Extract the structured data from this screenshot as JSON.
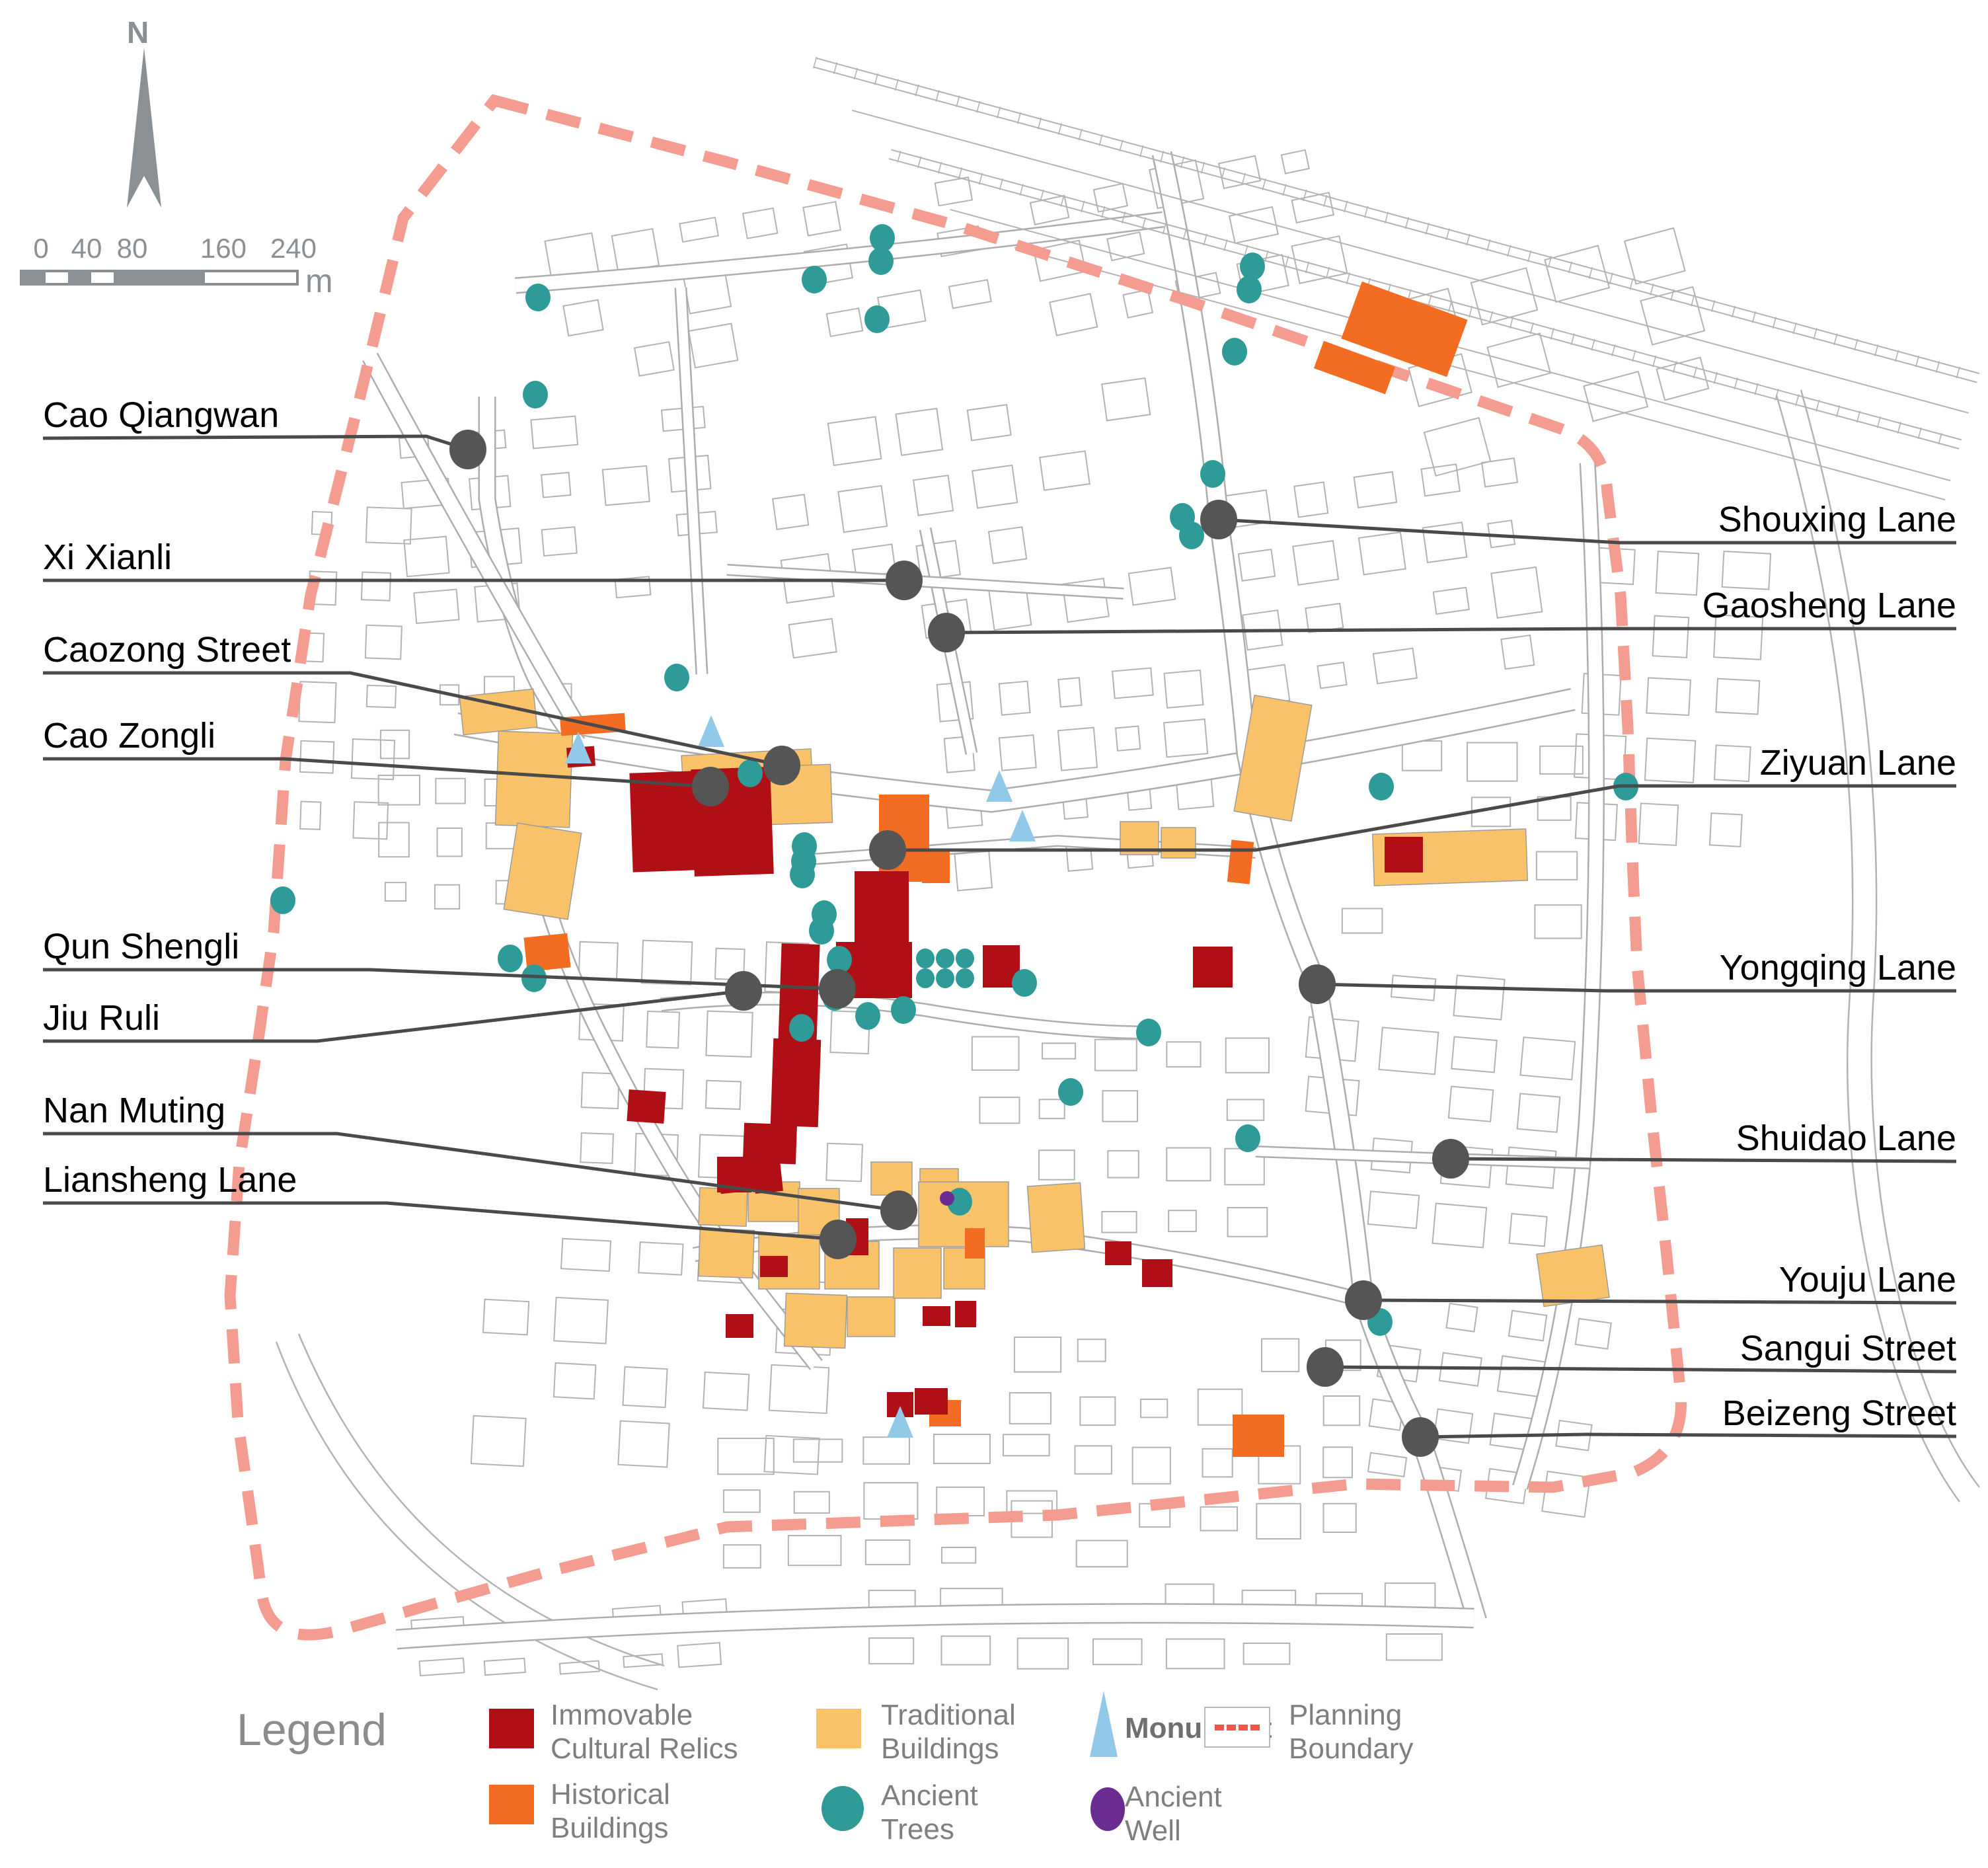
{
  "compass": {
    "north_label": "N"
  },
  "scale_bar": {
    "tick_labels": [
      "0",
      "40",
      "80",
      "160",
      "240"
    ],
    "unit_label": "m"
  },
  "streets_left": [
    "Cao Qiangwan",
    "Xi Xianli",
    "Caozong Street",
    "Cao Zongli",
    "Qun Shengli",
    "Jiu Ruli",
    "Nan Muting",
    "Liansheng Lane"
  ],
  "streets_right": [
    "Shouxing Lane",
    "Gaosheng Lane",
    "Ziyuan Lane",
    "Yongqing Lane",
    "Shuidao Lane",
    "Youju Lane",
    "Sangui Street",
    "Beizeng Street"
  ],
  "legend": {
    "title": "Legend",
    "items": [
      {
        "id": "immovable",
        "label": "Immovable Cultural Relics",
        "marker": "square",
        "color": "#B01015"
      },
      {
        "id": "historical",
        "label": "Historical Buildings",
        "marker": "square",
        "color": "#F26C21"
      },
      {
        "id": "traditional",
        "label": "Traditional Buildings",
        "marker": "square",
        "color": "#FBC369"
      },
      {
        "id": "ancient-trees",
        "label": "Ancient Trees",
        "marker": "circle",
        "color": "#2E9B98"
      },
      {
        "id": "monument",
        "label": "Monument",
        "marker": "triangle",
        "color": "#92C9E9"
      },
      {
        "id": "ancient-well",
        "label": "Ancient Well",
        "marker": "circle",
        "color": "#6A2C91"
      },
      {
        "id": "planning-boundary",
        "label": "Planning Boundary",
        "marker": "dashed-line",
        "color": "#F4544B"
      }
    ]
  },
  "colors": {
    "immovable": "#B01015",
    "historical": "#F26C21",
    "traditional": "#FBC369",
    "tree": "#2E9B98",
    "monument": "#92C9E9",
    "well": "#6A2C91",
    "boundary": "#F59C90",
    "map_line": "#B3B3B3",
    "road_edge": "#ADADAD",
    "leader": "#4A4A4A",
    "label_dot": "#555555",
    "gray_ui": "#8A9094"
  }
}
